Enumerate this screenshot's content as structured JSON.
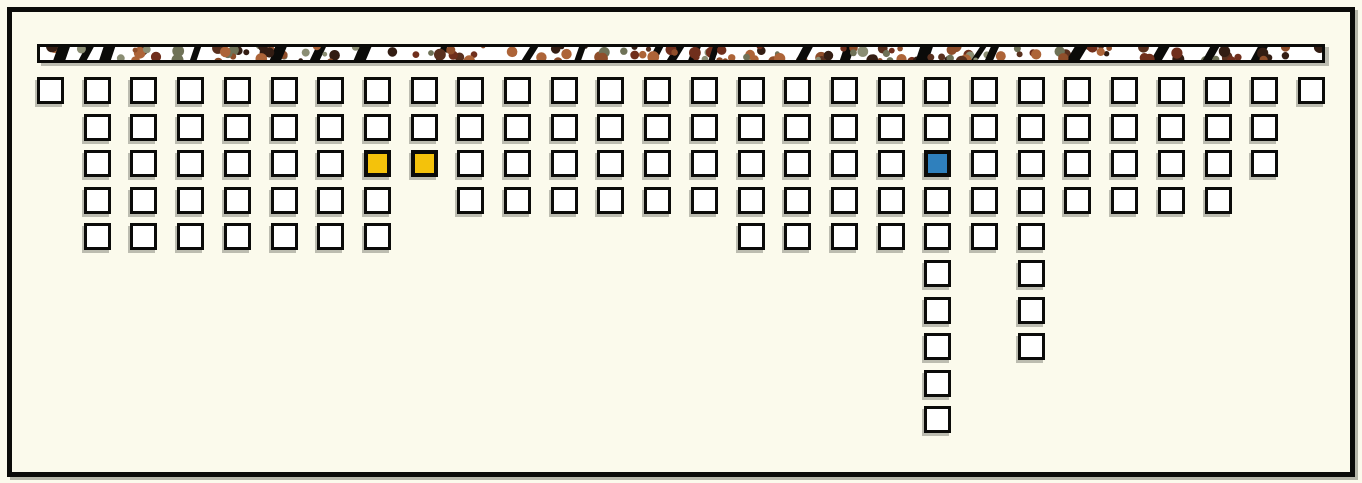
{
  "canvas": {
    "width": 1362,
    "height": 483,
    "background_color": "#FBFAEC",
    "frame_border_color": "#0B0B09",
    "shadow_color": "rgba(125,125,115,0.55)"
  },
  "banner": {
    "fill": "#FFFFFF",
    "border_color": "#0B0B09",
    "dot_colors": [
      "#6F7257",
      "#8B8E74",
      "#59301E",
      "#8F4E2A",
      "#AD6438",
      "#331D13",
      "#702F1C"
    ],
    "slash_color": "#0B0B09"
  },
  "grid": {
    "columns": 28,
    "max_rows": 10,
    "origin": {
      "x": 37,
      "y": 77
    },
    "pitch": {
      "x": 46.7,
      "y": 36.6
    },
    "square": {
      "size": 27,
      "fill": "#FFFFFF",
      "border_color": "#0B0B09",
      "border_width": 3,
      "highlight_border_width": 4
    },
    "counts_per_column": [
      1,
      5,
      5,
      5,
      5,
      5,
      5,
      5,
      3,
      4,
      4,
      4,
      4,
      4,
      4,
      5,
      5,
      5,
      5,
      10,
      5,
      8,
      4,
      4,
      4,
      4,
      3,
      1
    ],
    "highlights": [
      {
        "column": 8,
        "row": 3,
        "color": "#F4C20B",
        "name": "gold-highlight-1"
      },
      {
        "column": 9,
        "row": 3,
        "color": "#F4C20B",
        "name": "gold-highlight-2"
      },
      {
        "column": 20,
        "row": 3,
        "color": "#2F80BD",
        "name": "blue-highlight"
      }
    ]
  },
  "chart_data": {
    "type": "bar",
    "orientation": "columns-of-squares-descending-from-top",
    "unit": "squares",
    "categories": [
      "1",
      "2",
      "3",
      "4",
      "5",
      "6",
      "7",
      "8",
      "9",
      "10",
      "11",
      "12",
      "13",
      "14",
      "15",
      "16",
      "17",
      "18",
      "19",
      "20",
      "21",
      "22",
      "23",
      "24",
      "25",
      "26",
      "27",
      "28"
    ],
    "values": [
      1,
      5,
      5,
      5,
      5,
      5,
      5,
      5,
      3,
      4,
      4,
      4,
      4,
      4,
      4,
      5,
      5,
      5,
      5,
      10,
      5,
      8,
      4,
      4,
      4,
      4,
      3,
      1
    ],
    "title": "",
    "xlabel": "",
    "ylabel": "",
    "legend": "none",
    "gridlines": "off",
    "annotations": [
      {
        "column": 8,
        "row": 3,
        "color_hex": "#F4C20B",
        "color_name": "gold"
      },
      {
        "column": 9,
        "row": 3,
        "color_hex": "#F4C20B",
        "color_name": "gold"
      },
      {
        "column": 20,
        "row": 3,
        "color_hex": "#2F80BD",
        "color_name": "blue"
      }
    ],
    "total_squares": 126
  }
}
